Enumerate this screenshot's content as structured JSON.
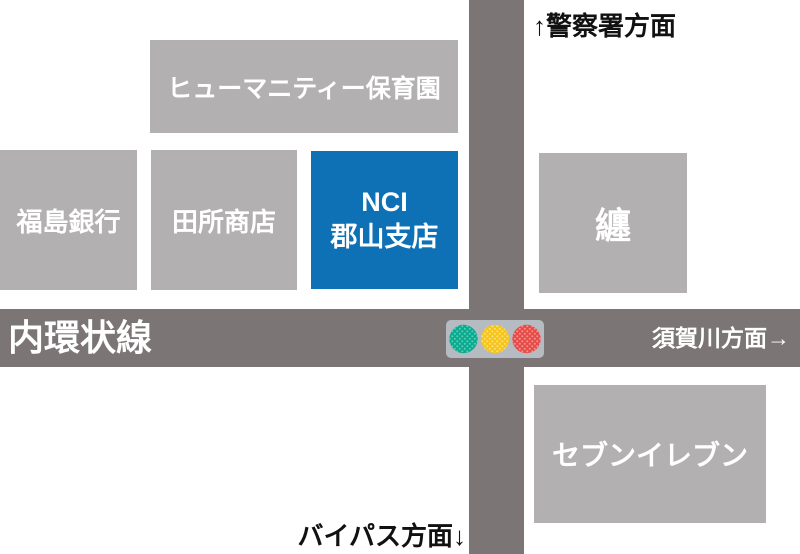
{
  "map": {
    "title": "access-map",
    "roads": {
      "horizontal_name": "内環状線"
    },
    "directions": {
      "north": "↑警察署方面",
      "east": "須賀川方面→",
      "south": "バイパス方面↓"
    },
    "buildings": {
      "nursery": {
        "label": "ヒューマニティー保育園"
      },
      "bank": {
        "label": "福島銀行"
      },
      "tadokoro": {
        "label": "田所商店"
      },
      "nci": {
        "line1": "NCI",
        "line2": "郡山支店",
        "highlighted": true
      },
      "matoi": {
        "label": "纏"
      },
      "seven_eleven": {
        "label": "セブンイレブン"
      }
    },
    "traffic_light": {
      "icon": "traffic-light-icon",
      "lights": [
        "green",
        "yellow",
        "red"
      ]
    },
    "colors": {
      "building_gray": "#b3b0b1",
      "road_gray": "#7b7576",
      "nci_blue": "#0e71b6",
      "signal_body": "#b6bac1",
      "signal_green": "#0ba78e",
      "signal_yellow": "#f5c31d",
      "signal_red": "#e24b48",
      "label_white": "#ffffff",
      "direction_text": "#111111"
    }
  }
}
